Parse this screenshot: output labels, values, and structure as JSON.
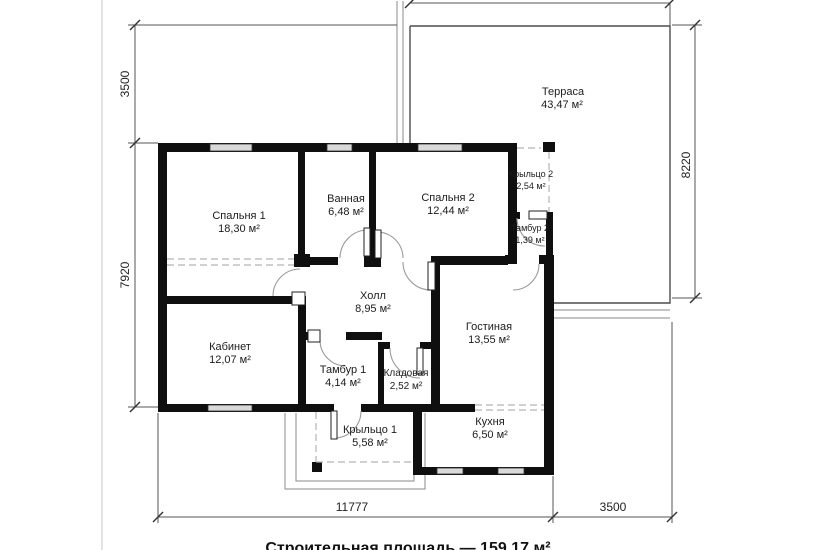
{
  "plan": {
    "rooms": [
      {
        "name": "Спальня 1",
        "area": "18,30 м²"
      },
      {
        "name": "Ванная",
        "area": "6,48 м²"
      },
      {
        "name": "Спальня 2",
        "area": "12,44 м²"
      },
      {
        "name": "Крыльцо 2",
        "area": "2,54 м²"
      },
      {
        "name": "Тамбур 2",
        "area": "1,39 м²"
      },
      {
        "name": "Холл",
        "area": "8,95 м²"
      },
      {
        "name": "Гостиная",
        "area": "13,55 м²"
      },
      {
        "name": "Кабинет",
        "area": "12,07 м²"
      },
      {
        "name": "Тамбур 1",
        "area": "4,14 м²"
      },
      {
        "name": "Кладовая",
        "area": "2,52 м²"
      },
      {
        "name": "Крыльцо 1",
        "area": "5,58 м²"
      },
      {
        "name": "Кухня",
        "area": "6,50 м²"
      },
      {
        "name": "Терраса",
        "area": "43,47 м²"
      }
    ],
    "dimensions": {
      "top_left_height": "3500",
      "left_height": "7920",
      "right_height": "8220",
      "bottom_width": "11777",
      "bottom_right_width": "3500"
    },
    "caption": "Строительная площадь — 159,17 м²",
    "colors": {
      "wall": "#0f0f0f",
      "dimension": "#555555",
      "background": "#ffffff"
    }
  }
}
